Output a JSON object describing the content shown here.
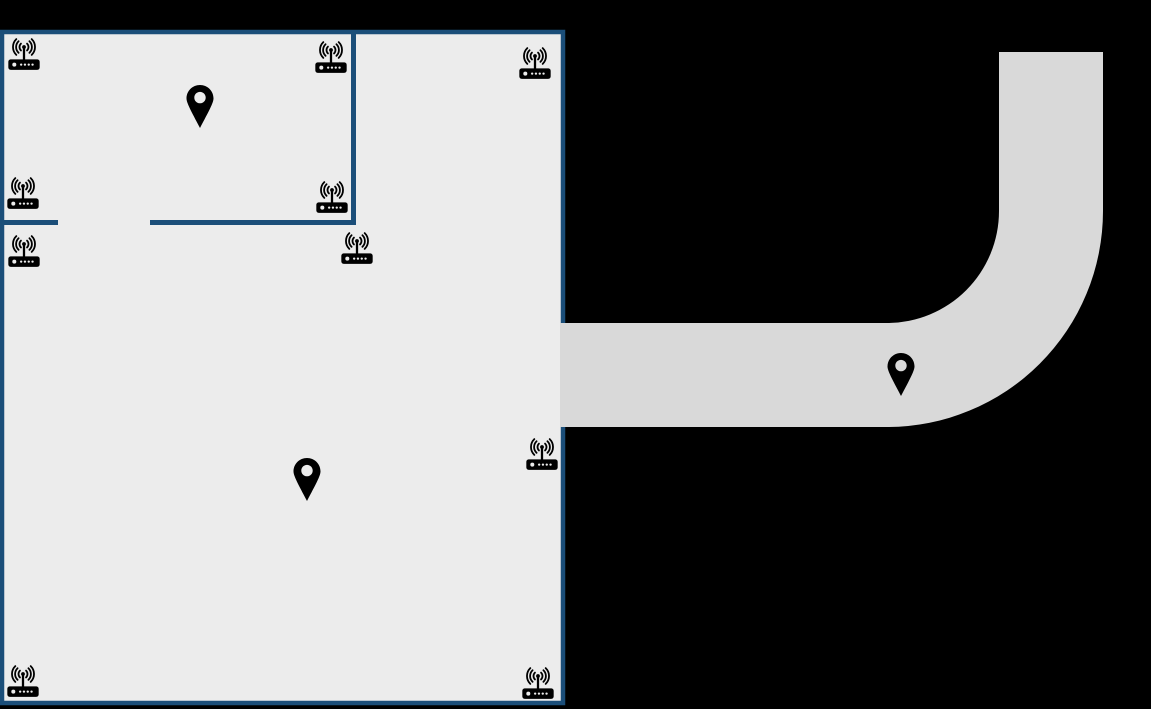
{
  "scene": {
    "description": "Indoor floor plan with wifi access points, location pins and an external corridor",
    "width": 1151,
    "height": 709,
    "colors": {
      "background": "#000000",
      "floor_fill": "#ececec",
      "wall": "#1b4e79",
      "corridor_fill": "#d9d9d9",
      "marker": "#000000"
    }
  },
  "floor_plan": {
    "outer": {
      "x": 2,
      "y": 32,
      "width": 561,
      "height": 671,
      "wall_thickness": 4.5
    },
    "inner_walls": [
      {
        "id": "inner-wall-vertical",
        "x1": 353.5,
        "y1": 32,
        "x2": 353.5,
        "y2": 225,
        "thickness": 5
      },
      {
        "id": "inner-wall-horizontal-left",
        "x1": 2,
        "y1": 222.5,
        "x2": 58,
        "y2": 222.5,
        "thickness": 5
      },
      {
        "id": "inner-wall-horizontal-right",
        "x1": 150,
        "y1": 222.5,
        "x2": 356,
        "y2": 222.5,
        "thickness": 5
      }
    ],
    "door_gap": {
      "y": 222.5,
      "x1": 58,
      "x2": 150
    }
  },
  "corridor": {
    "path": "M 560 323 H 887 A 112 112 0 0 0 999 211 V 52 H 1103 V 211 A 216 216 0 0 1 887 427 H 560 Z",
    "horizontal_band": {
      "x1": 560,
      "x2": 887,
      "y1": 323,
      "y2": 427
    },
    "vertical_band": {
      "x1": 999,
      "x2": 1103,
      "y1": 52,
      "y2": 211
    },
    "elbow": {
      "cx": 887,
      "cy": 211,
      "inner_radius": 112,
      "outer_radius": 216
    }
  },
  "routers": [
    {
      "id": "router-room-a-top-left",
      "cx": 24,
      "cy": 55
    },
    {
      "id": "router-room-a-top-right",
      "cx": 331,
      "cy": 58
    },
    {
      "id": "router-room-a-bottom-left",
      "cx": 23,
      "cy": 194
    },
    {
      "id": "router-room-a-bottom-right",
      "cx": 332,
      "cy": 198
    },
    {
      "id": "router-main-top-right",
      "cx": 535,
      "cy": 64
    },
    {
      "id": "router-main-left-upper",
      "cx": 24,
      "cy": 252
    },
    {
      "id": "router-main-center-upper",
      "cx": 357,
      "cy": 249
    },
    {
      "id": "router-main-right-middle",
      "cx": 542,
      "cy": 455
    },
    {
      "id": "router-main-bottom-left",
      "cx": 23,
      "cy": 682
    },
    {
      "id": "router-main-bottom-right",
      "cx": 538,
      "cy": 684
    }
  ],
  "pins": [
    {
      "id": "pin-room-a",
      "tip_x": 200,
      "tip_y": 128
    },
    {
      "id": "pin-main-room",
      "tip_x": 307,
      "tip_y": 501
    },
    {
      "id": "pin-corridor",
      "tip_x": 901,
      "tip_y": 396
    }
  ]
}
